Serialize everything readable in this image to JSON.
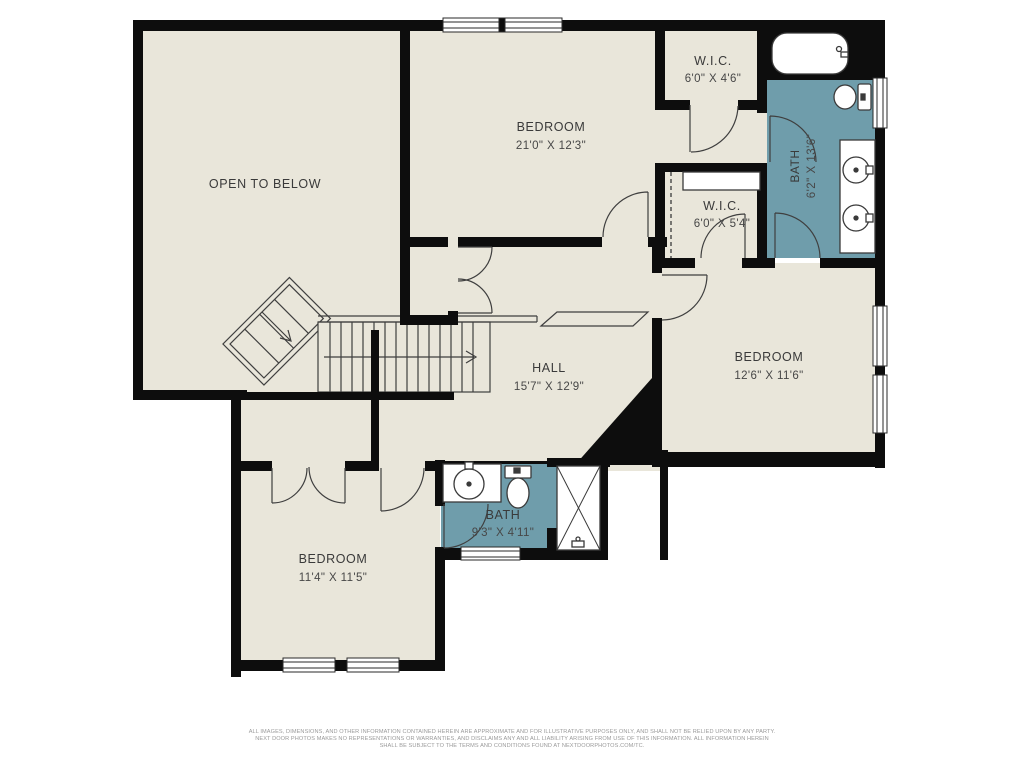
{
  "plan": {
    "title": "Second floor plan",
    "rooms": [
      {
        "id": "open-to-below",
        "name": "OPEN TO BELOW",
        "dims": ""
      },
      {
        "id": "bedroom-master",
        "name": "BEDROOM",
        "dims": "21'0\" X 12'3\""
      },
      {
        "id": "wic-top",
        "name": "W.I.C.",
        "dims": "6'0\" X 4'6\""
      },
      {
        "id": "bath-master",
        "name": "BATH",
        "dims": "6'2\" X 13'6\""
      },
      {
        "id": "wic-mid",
        "name": "W.I.C.",
        "dims": "6'0\" X 5'4\""
      },
      {
        "id": "bedroom-right",
        "name": "BEDROOM",
        "dims": "12'6\" X 11'6\""
      },
      {
        "id": "hall",
        "name": "HALL",
        "dims": "15'7\" X 12'9\""
      },
      {
        "id": "bedroom-lower",
        "name": "BEDROOM",
        "dims": "11'4\" X 11'5\""
      },
      {
        "id": "bath-lower",
        "name": "BATH",
        "dims": "9'3\" X 4'11\""
      }
    ],
    "fixtures": [
      "bathtub",
      "toilet",
      "double-vanity-sinks",
      "vanity-sink",
      "shower",
      "closet-shelf",
      "closet-rod",
      "stairs"
    ],
    "colors": {
      "floor": "#e9e6da",
      "bath_floor": "#6f9dab",
      "wall": "#0d0d0d",
      "line": "#3f3f3f",
      "label_text": "#3a3a3a",
      "disclaimer_text": "#9a9a9a"
    }
  },
  "disclaimer": {
    "line1": "ALL IMAGES, DIMENSIONS, AND OTHER INFORMATION CONTAINED HEREIN ARE APPROXIMATE AND FOR ILLUSTRATIVE PURPOSES ONLY, AND SHALL NOT BE RELIED UPON BY ANY PARTY.",
    "line2": "NEXT DOOR PHOTOS MAKES NO REPRESENTATIONS OR WARRANTIES, AND DISCLAIMS ANY AND ALL LIABILITY ARISING FROM USE OF THIS INFORMATION. ALL INFORMATION HEREIN",
    "line3": "SHALL BE SUBJECT TO THE TERMS AND CONDITIONS FOUND AT NEXTDOORPHOTOS.COM/TC."
  }
}
